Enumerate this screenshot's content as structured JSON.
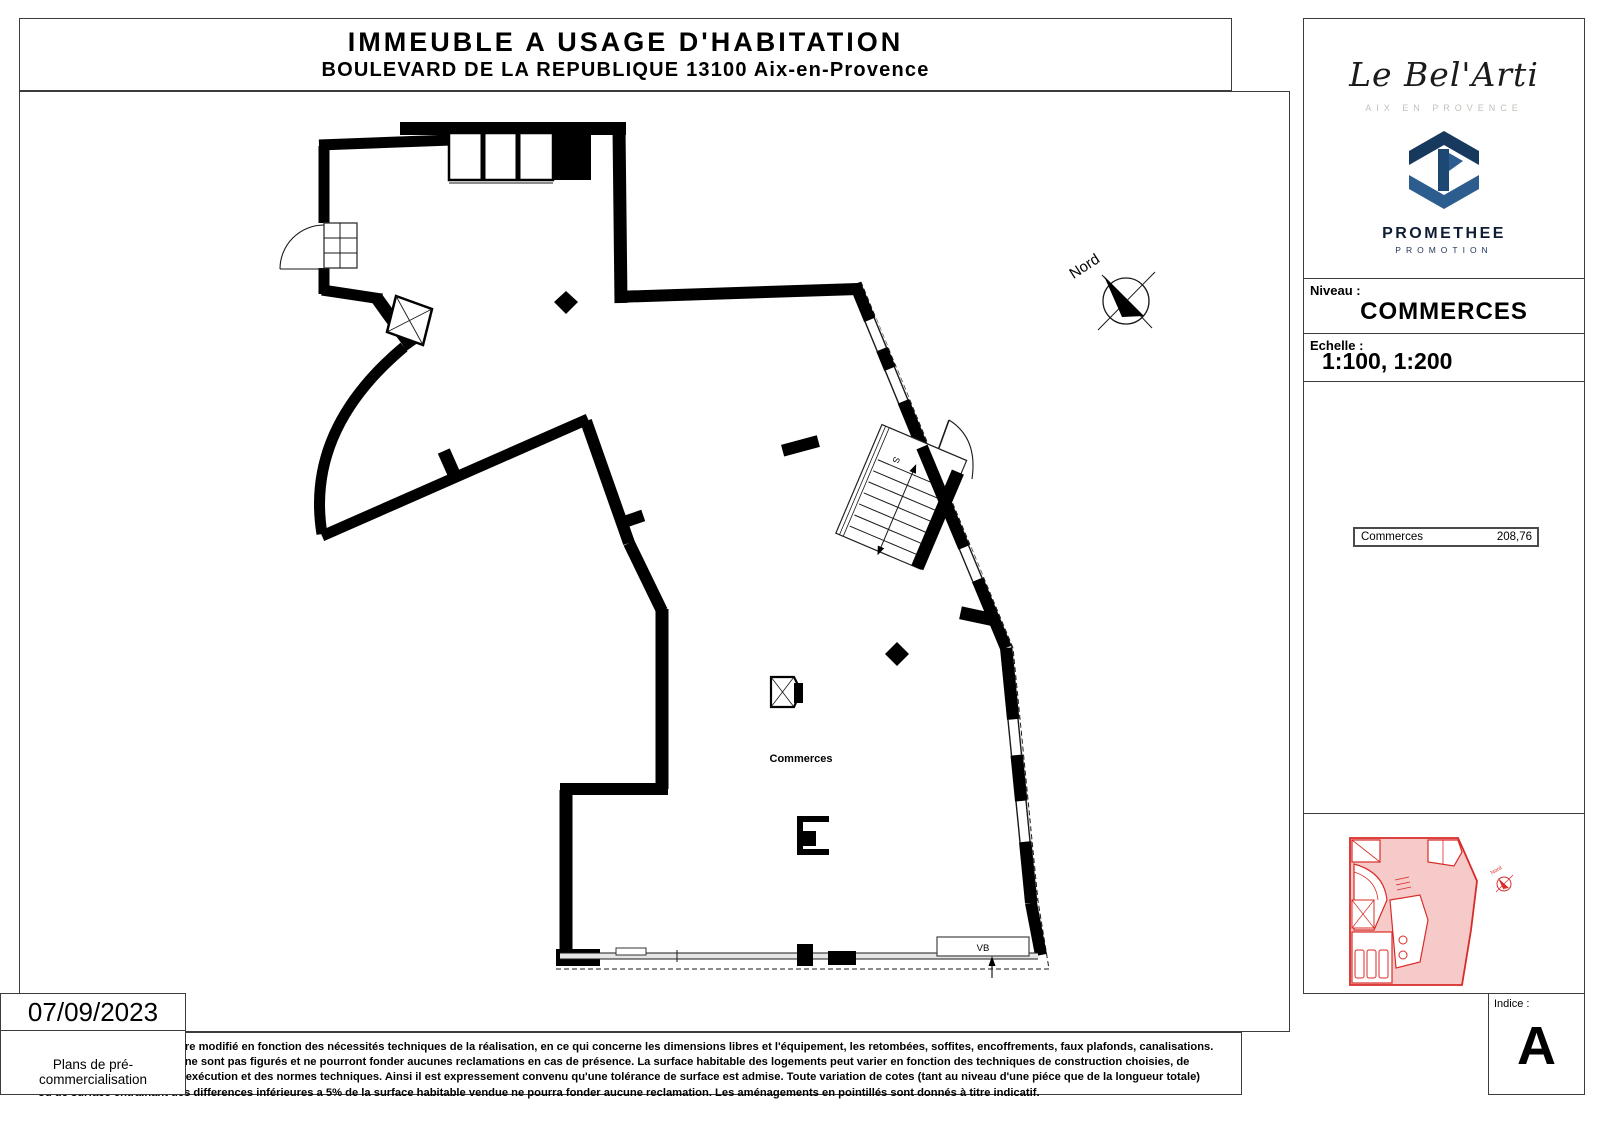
{
  "title_block": {
    "line1": "IMMEUBLE A USAGE D'HABITATION",
    "line2": "BOULEVARD DE LA REPUBLIQUE 13100 Aix-en-Provence"
  },
  "plan": {
    "room_label": "Commerces",
    "vb_label": "VB",
    "stair_label": "S",
    "north_label": "Nord"
  },
  "sidebar": {
    "brand": {
      "name": "Le Bel'Arti",
      "subtitle": "AIX EN PROVENCE"
    },
    "promoter": {
      "name": "PROMETHEE",
      "subtitle": "PROMOTION"
    },
    "niveau": {
      "label": "Niveau :",
      "value": "COMMERCES"
    },
    "echelle": {
      "label": "Echelle :",
      "value": "1:100, 1:200"
    },
    "surface_table": {
      "rows": [
        {
          "label": "Commerces",
          "value": "208,76"
        }
      ]
    },
    "miniplan": {
      "north_label": "Nord"
    },
    "date": "07/09/2023",
    "doc_type": "Plans de pré-commercialisation",
    "indice": {
      "label": "Indice :",
      "value": "A"
    }
  },
  "disclaimer": {
    "lines": [
      "Ce plan est susceptible d'etre modifié en fonction des nécessités techniques de la réalisation, en ce qui concerne les dimensions libres et l'équipement, les retombées, soffites, encoffrements, faux plafonds, canalisations.",
      "Radiateurs ou convecteurs ne sont pas figurés et ne pourront fonder aucunes reclamations en cas de présence. La surface habitable des logements peut varier en fonction des techniques de construction choisies, de",
      "l'établissement des plans d'exécution et des normes techniques. Ainsi il est expressement convenu qu'une tolérance de surface est admise. Toute variation de cotes (tant au niveau d'une piéce que de la longueur totale)",
      "ou de surface entrainant des differences inférieures a 5% de la surface habitable vendue ne pourra fonder aucune reclamation. Les aménagements en pointillés sont donnés à titre indicatif."
    ]
  },
  "colors": {
    "wall": "#000000",
    "accent_red": "#d92b27",
    "brand_navy": "#14213d",
    "logo_blue_dark": "#17395e",
    "logo_blue": "#2d5d8e"
  }
}
